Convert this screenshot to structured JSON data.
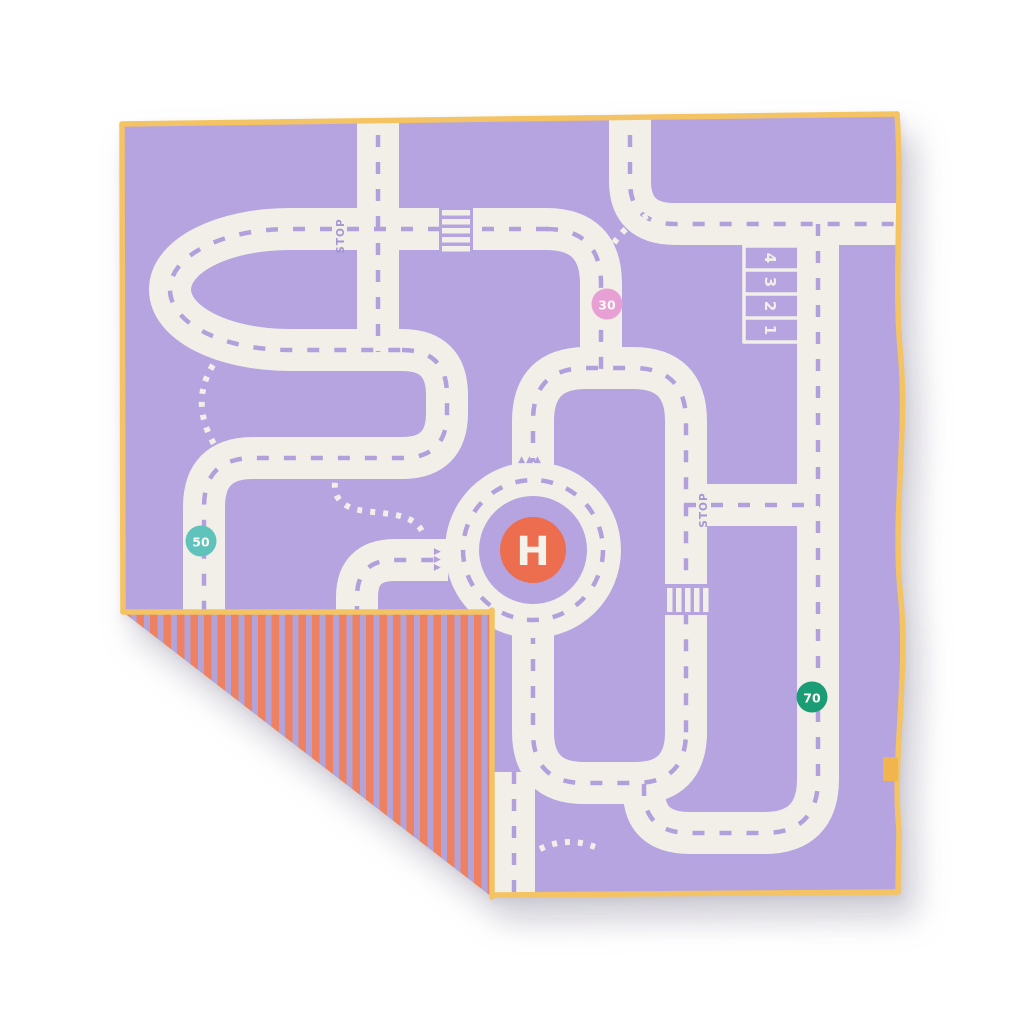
{
  "playmat": {
    "speed_signs": [
      {
        "value": "30",
        "color": "#e7a0d4"
      },
      {
        "value": "50",
        "color": "#5fc3bb"
      },
      {
        "value": "70",
        "color": "#1a9c74"
      }
    ],
    "helipad": {
      "label": "H",
      "color": "#ed6e4e"
    },
    "road_markings": {
      "stop_west": "STOP",
      "stop_east": "STOP",
      "yield_row": "▲▲▲",
      "yield_column": "▲▲▲"
    },
    "parking_bay_numbers": [
      "4",
      "3",
      "2",
      "1"
    ],
    "colors": {
      "mat_purple": "#b5a4e0",
      "road_white": "#f2efe9",
      "lane_dash": "#b1a0dc",
      "marking_text": "#a396d3",
      "trim_yellow": "#f4c363",
      "fold_stripe_coral": "#ee8162",
      "fold_stripe_lilac": "#b2a4d8",
      "tag_yellow": "#f0b54e",
      "background": "#ffffff"
    }
  }
}
